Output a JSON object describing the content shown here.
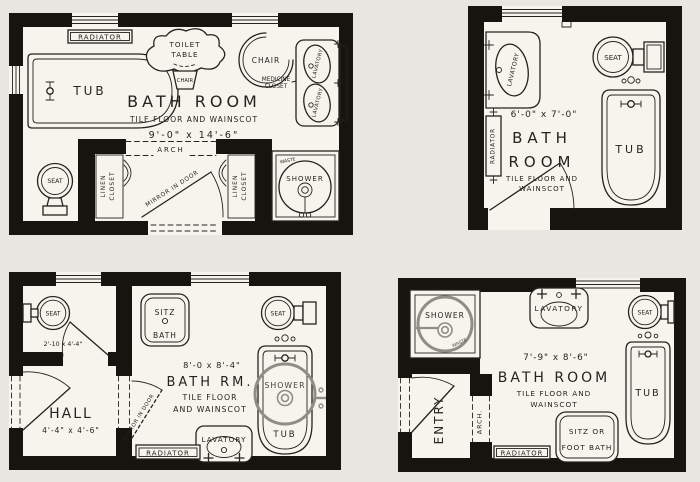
{
  "sheet": {
    "description": "Four bathroom floor plans, scanned drawing"
  },
  "colors": {
    "paper": "#e8e6e0",
    "room": "#f6f4ed",
    "wall": "#17140f",
    "ink": "#26231e",
    "shower_gray": "#908d86"
  },
  "plans": [
    {
      "id": "plan-large-bathroom",
      "title": "BATH ROOM",
      "subtitle": "TILE FLOOR AND WAINSCOT",
      "dimensions": "9'-0\" x 14'-6\"",
      "labels": {
        "radiator": "RADIATOR",
        "toilet_table_1": "TOILET",
        "toilet_table_2": "TABLE",
        "toilet_table_chair": "CHAIR",
        "chair": "CHAIR",
        "medicine_1": "MEDICINE",
        "medicine_2": "CLOSET",
        "lavatory_upper": "LAVATORY",
        "lavatory_lower": "LAVATORY",
        "tub": "TUB",
        "arch": "ARCH",
        "seat": "SEAT",
        "linen_left_1": "LINEN",
        "linen_left_2": "CLOSET",
        "linen_right_1": "LINEN",
        "linen_right_2": "CLOSET",
        "mirror_door": "MIRROR IN DOOR",
        "shower": "SHOWER",
        "waste": "WASTE"
      }
    },
    {
      "id": "plan-small-bathroom",
      "title_1": "BATH",
      "title_2": "ROOM",
      "subtitle_1": "TILE FLOOR AND",
      "subtitle_2": "WAINSCOT",
      "dimensions": "6'-0\" x 7'-0\"",
      "labels": {
        "lavatory": "LAVATORY",
        "radiator": "RADIATOR",
        "seat": "SEAT",
        "tub": "TUB"
      }
    },
    {
      "id": "plan-bathroom-with-hall",
      "title": "BATH RM.",
      "subtitle_1": "TILE FLOOR",
      "subtitle_2": "AND WAINSCOT",
      "dimensions": "8'-0 x 8'-4\"",
      "labels": {
        "seat_wc": "SEAT",
        "wc_dimensions": "2'-10 x 4'-4\"",
        "sitz_1": "SITZ",
        "sitz_2": "BATH",
        "seat": "SEAT",
        "hall": "HALL",
        "hall_dimensions": "4'-4\" x 4'-6\"",
        "mirror_door": "MIRROR IN DOOR",
        "shower": "SHOWER",
        "tub": "TUB",
        "lavatory": "LAVATORY",
        "radiator": "RADIATOR"
      }
    },
    {
      "id": "plan-bathroom-with-entry",
      "title": "BATH ROOM",
      "subtitle_1": "TILE FLOOR AND",
      "subtitle_2": "WAINSCOT",
      "dimensions": "7'-9\" x 8'-6\"",
      "labels": {
        "shower": "SHOWER",
        "waste": "WASTE",
        "lavatory": "LAVATORY",
        "seat": "SEAT",
        "tub": "TUB",
        "entry": "ENTRY",
        "arch": "ARCH.",
        "radiator": "RADIATOR",
        "sitz_1": "SITZ OR",
        "sitz_2": "FOOT BATH"
      }
    }
  ]
}
